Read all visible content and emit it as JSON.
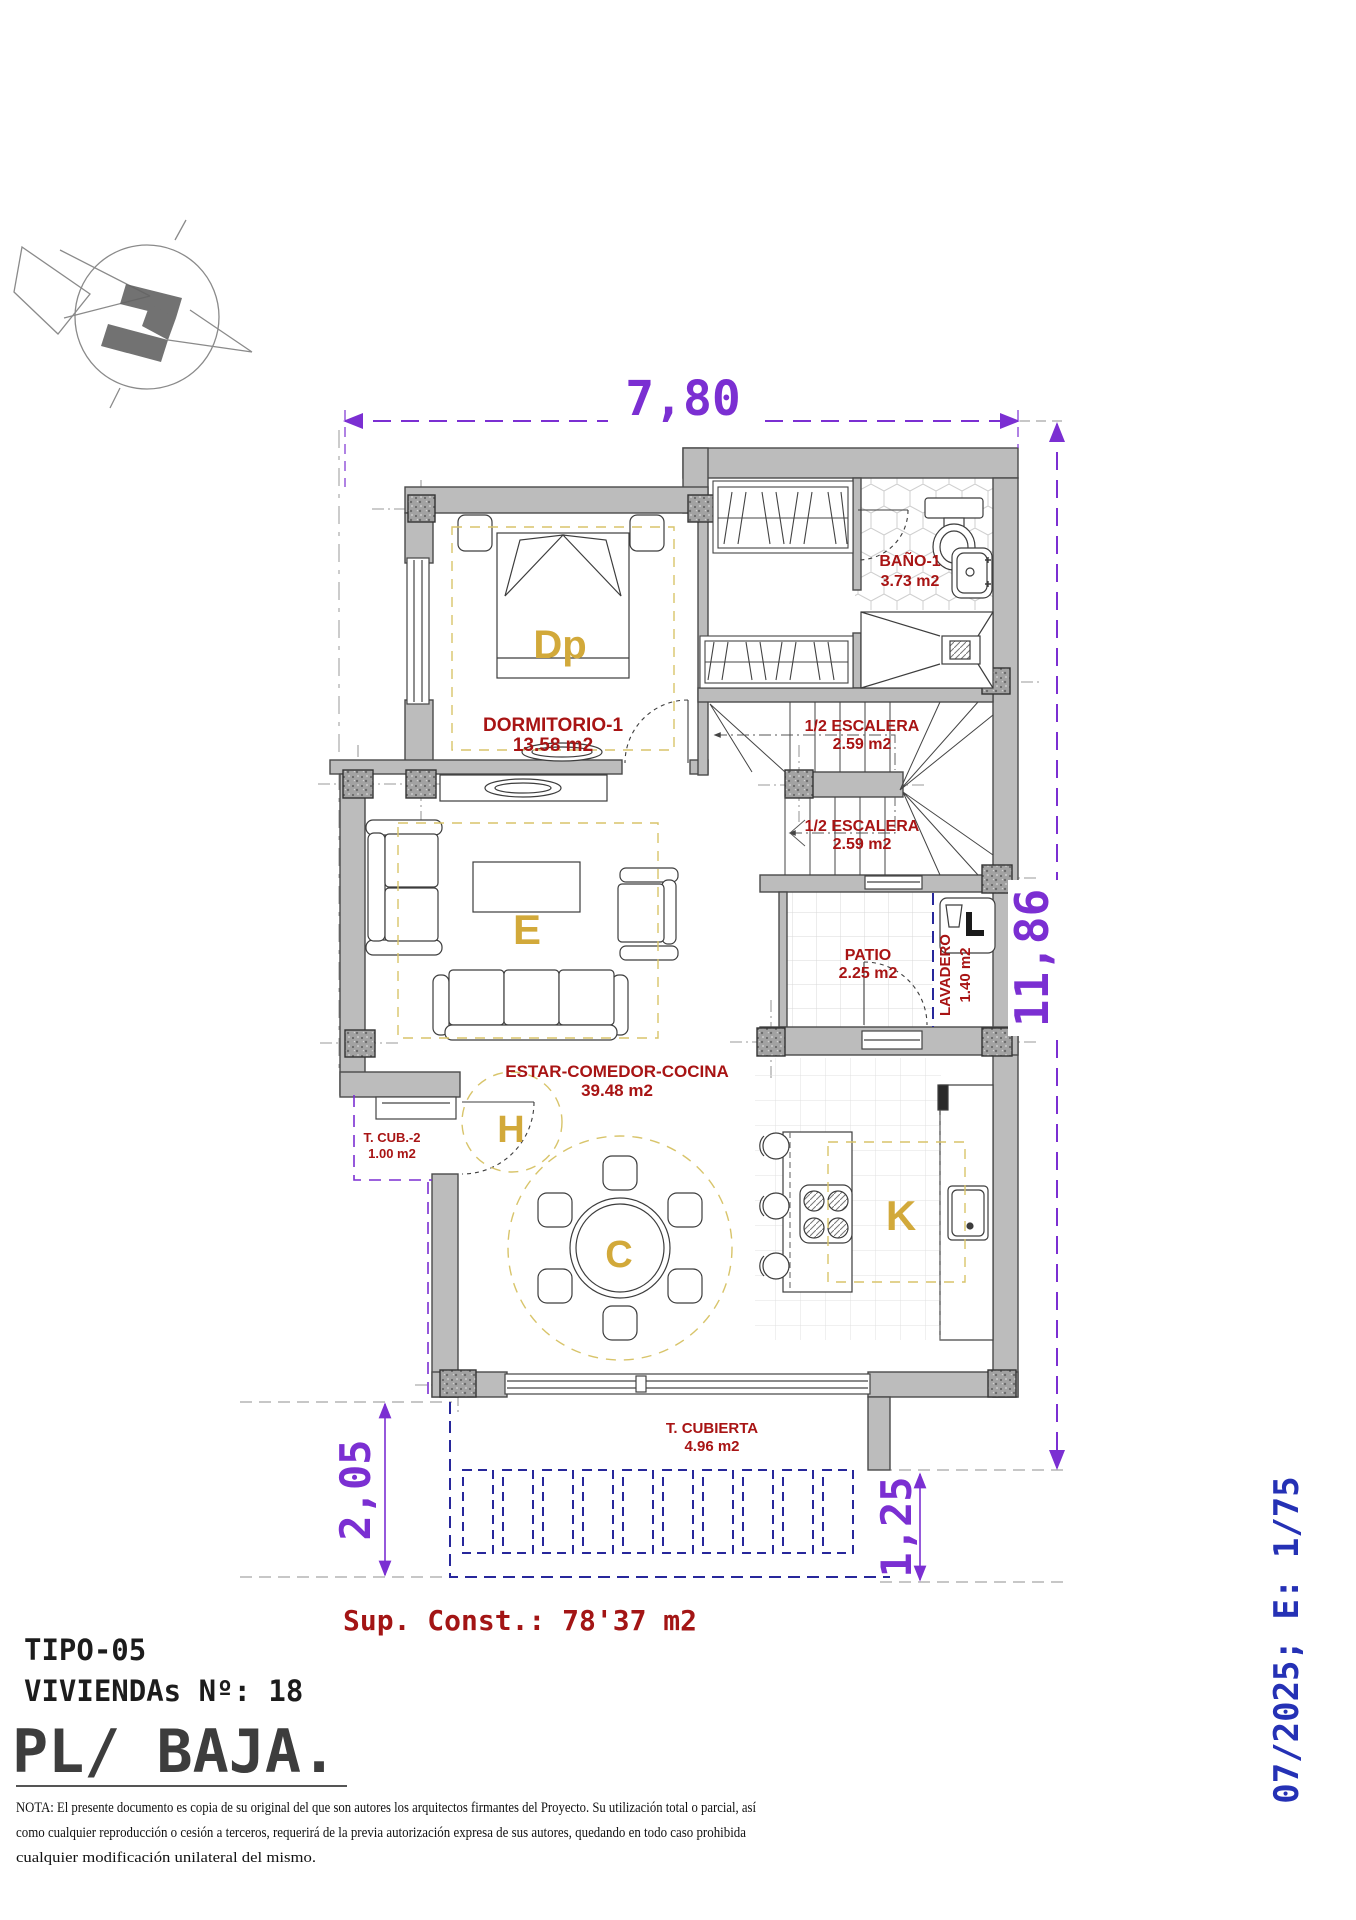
{
  "colors": {
    "wall_gray": "#bcbcbc",
    "column_gray": "#9b9b9b",
    "dimension_purple": "#7b2fd2",
    "label_red": "#a81414",
    "letter_gold": "#d2a93a",
    "zone_dash_gold": "#d8c46a",
    "pergola_navy": "#28289b",
    "revision_blue": "#2531b5"
  },
  "dimensions": {
    "top": "7,80",
    "right": "11,86",
    "bottom_left": "2,05",
    "bottom_right": "1,25"
  },
  "rooms": {
    "dormitorio1": {
      "name": "DORMITORIO-1",
      "area": "13.58 m2",
      "letter": "Dp"
    },
    "bano1": {
      "name": "BAÑO-1",
      "area": "3.73 m2"
    },
    "escalera_superior": {
      "name": "1/2 ESCALERA",
      "area": "2.59 m2"
    },
    "escalera_inferior": {
      "name": "1/2 ESCALERA",
      "area": "2.59 m2"
    },
    "patio": {
      "name": "PATIO",
      "area": "2.25 m2"
    },
    "lavadero": {
      "name": "LAVADERO",
      "area": "1.40 m2"
    },
    "estar_comedor_cocina": {
      "name": "ESTAR-COMEDOR-COCINA",
      "area": "39.48 m2",
      "letter_estar": "E",
      "letter_hall": "H",
      "letter_comedor": "C",
      "letter_cocina": "K"
    },
    "terraza_cubierta_2": {
      "name": "T. CUB.-2",
      "area": "1.00 m2"
    },
    "terraza_cubierta": {
      "name": "T. CUBIERTA",
      "area": "4.96 m2"
    }
  },
  "summary": {
    "sup_const": "Sup. Const.: 78'37 m2"
  },
  "title_block": {
    "tipo": "TIPO-05",
    "viviendas": "VIVIENDAs Nº: 18",
    "planta": "PL/ BAJA."
  },
  "revision_label": "07/2025; E: 1/75",
  "nota": {
    "line1": "NOTA: El presente documento es copia de su original del que son autores los arquitectos firmantes del Proyecto. Su utilización total o parcial, así",
    "line2": "como cualquier reproducción o cesión a terceros, requerirá  de la previa autorización expresa de sus autores, quedando en todo caso prohibida",
    "line3": "cualquier modificación unilateral del mismo."
  }
}
